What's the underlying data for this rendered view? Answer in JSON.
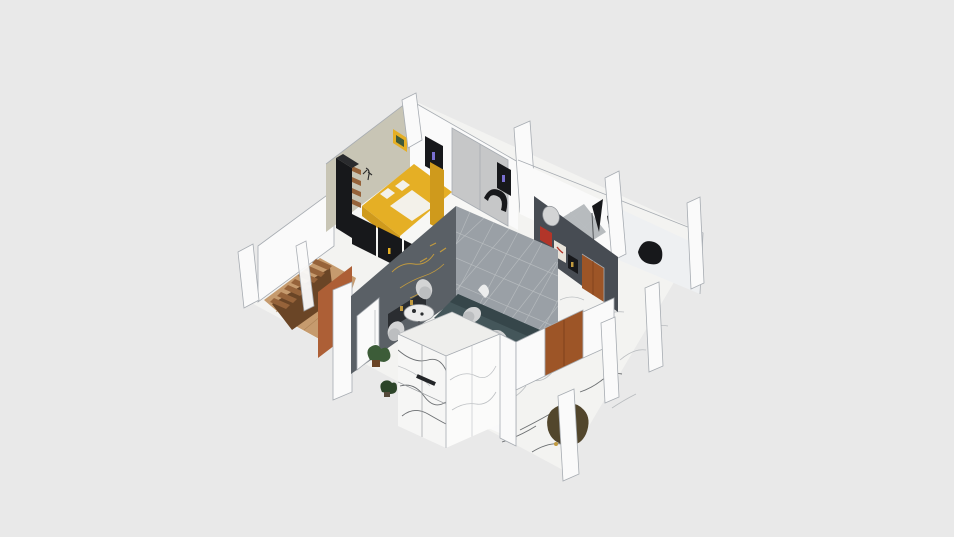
{
  "app": {
    "view_type": "3d-floorplan-render",
    "camera": "isometric-top-angled",
    "visible_text": "none"
  },
  "palette": {
    "background": "#e9e9e9",
    "floor_marble": "#f3f3f1",
    "marble_vein": "#a9adb1",
    "vein_dark": "#54575b",
    "wall_white": "#fafafa",
    "wall_shade": "#eef0f2",
    "wall_outline": "#a7acb2",
    "wall_beige": "#c8c5b5",
    "panel_gray": "#c6c7c8",
    "wall_charcoal": "#5a6066",
    "wall_dark": "#474c53",
    "wall_pattern": "#9aa0a6",
    "pattern_line": "#b8bcc0",
    "mural_gold": "#c19a3f",
    "bed_yellow": "#e5af25",
    "bed_yellow_dark": "#cf9a1c",
    "linen_white": "#f3f1ea",
    "furniture_black": "#17181b",
    "wood_stair": "#96633a",
    "wood_dark": "#6a4526",
    "wood_floor": "#c69b6e",
    "plank_line": "#a87e52",
    "door_rust": "#ad5f36",
    "wood_door": "#9d5527",
    "sofa_teal": "#44565a",
    "sofa_teal_dark": "#36464a",
    "chair_gray": "#d3d4d5",
    "chair_gray_dark": "#bcbec0",
    "table_white": "#ececec",
    "chair_olive": "#52462c",
    "plant_green": "#3c5c38",
    "plant_dark": "#2c4429",
    "tile_gray": "#b7bbbe",
    "art_red": "#b23529",
    "art_white": "#e8e3da",
    "accent_purple": "#7a6fd1"
  },
  "objects": [
    {
      "name": "double-bed",
      "color_ref": "bed_yellow"
    },
    {
      "name": "bed-headboard-panel",
      "color_ref": "bed_yellow_dark"
    },
    {
      "name": "wardrobe-tall-black",
      "color_ref": "furniture_black"
    },
    {
      "name": "wall-shelf-boxes",
      "color_ref": "wood_stair"
    },
    {
      "name": "wall-art-yellow-frame",
      "color_ref": "bed_yellow"
    },
    {
      "name": "wall-art-black-frames",
      "color_ref": "furniture_black"
    },
    {
      "name": "closet-sliding-panel",
      "color_ref": "panel_gray"
    },
    {
      "name": "tv-low-cabinets-black",
      "color_ref": "furniture_black"
    },
    {
      "name": "curved-lounge-chair-black",
      "color_ref": "furniture_black"
    },
    {
      "name": "accent-wall-gold-mural",
      "color_ref": "mural_gold"
    },
    {
      "name": "interior-door-white",
      "color_ref": "wall_white"
    },
    {
      "name": "quilted-pattern-accent-wall",
      "color_ref": "wall_pattern"
    },
    {
      "name": "sofa-teal",
      "color_ref": "sofa_teal"
    },
    {
      "name": "dining-table-small",
      "color_ref": "table_white"
    },
    {
      "name": "dining-table-round",
      "color_ref": "table_white"
    },
    {
      "name": "dining-chairs-gray",
      "color_ref": "chair_gray"
    },
    {
      "name": "kitchen-island-marble",
      "color_ref": "floor_marble"
    },
    {
      "name": "potted-plants",
      "color_ref": "plant_green"
    },
    {
      "name": "staircase-wood",
      "color_ref": "wood_stair"
    },
    {
      "name": "hallway-wood-floor",
      "color_ref": "wood_floor"
    },
    {
      "name": "rust-accent-wall",
      "color_ref": "door_rust"
    },
    {
      "name": "entry-door-brown-south",
      "color_ref": "wood_door"
    },
    {
      "name": "entry-door-brown-east",
      "color_ref": "wood_door"
    },
    {
      "name": "oval-wall-mirror",
      "color_ref": "chair_gray"
    },
    {
      "name": "display-cabinet-artwork",
      "color_ref": "art_red"
    },
    {
      "name": "armchair-olive",
      "color_ref": "chair_olive"
    },
    {
      "name": "side-chair-black",
      "color_ref": "furniture_black"
    },
    {
      "name": "bathroom-tile-floor",
      "color_ref": "tile_gray"
    },
    {
      "name": "cut-wall-columns-white",
      "color_ref": "wall_white"
    }
  ]
}
